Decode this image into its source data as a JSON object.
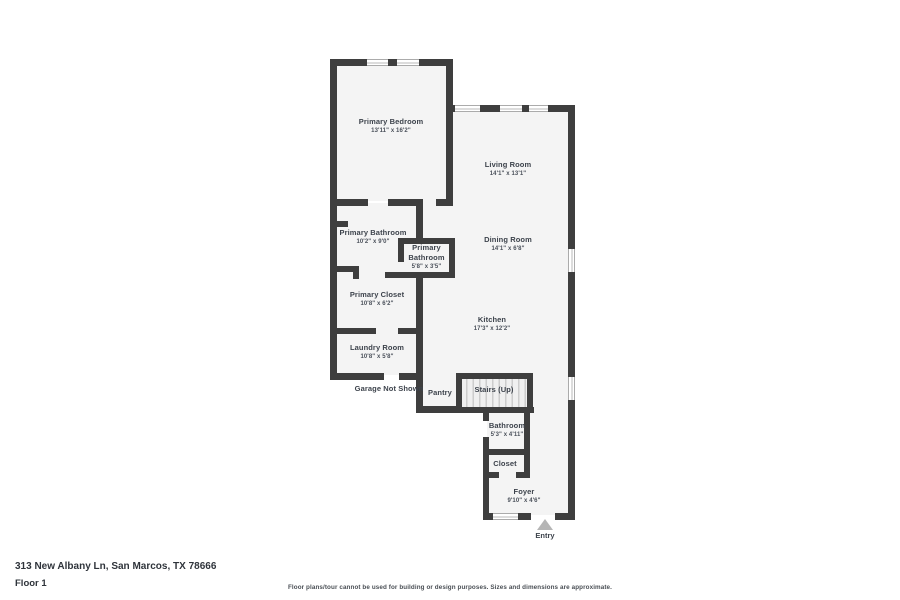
{
  "plan": {
    "wall_color": "#3e3e3e",
    "room_fill": "#f4f4f4",
    "rooms": [
      {
        "id": "primary-bedroom",
        "name": "Primary Bedroom",
        "dims": "13'11\" x 16'2\""
      },
      {
        "id": "living-room",
        "name": "Living Room",
        "dims": "14'1\" x 13'1\""
      },
      {
        "id": "primary-bathroom",
        "name": "Primary Bathroom",
        "dims": "10'2\" x 9'0\""
      },
      {
        "id": "primary-bathroom-2",
        "name": "Primary Bathroom",
        "dims": "5'8\" x 3'5\""
      },
      {
        "id": "dining-room",
        "name": "Dining Room",
        "dims": "14'1\" x 6'8\""
      },
      {
        "id": "primary-closet",
        "name": "Primary Closet",
        "dims": "10'8\" x 6'2\""
      },
      {
        "id": "kitchen",
        "name": "Kitchen",
        "dims": "17'3\" x 12'2\""
      },
      {
        "id": "laundry-room",
        "name": "Laundry Room",
        "dims": "10'8\" x 5'8\""
      },
      {
        "id": "garage-note",
        "name": "Garage Not Shown",
        "dims": ""
      },
      {
        "id": "pantry",
        "name": "Pantry",
        "dims": ""
      },
      {
        "id": "stairs-up",
        "name": "Stairs (Up)",
        "dims": ""
      },
      {
        "id": "bathroom",
        "name": "Bathroom",
        "dims": "5'3\" x 4'11\""
      },
      {
        "id": "closet",
        "name": "Closet",
        "dims": ""
      },
      {
        "id": "foyer",
        "name": "Foyer",
        "dims": "9'10\" x 4'6\""
      }
    ],
    "entry_label": "Entry"
  },
  "footer": {
    "address": "313 New Albany Ln, San Marcos, TX 78666",
    "floor": "Floor 1",
    "disclaimer": "Floor plans/tour cannot be used for building or design purposes. Sizes and dimensions are approximate."
  }
}
